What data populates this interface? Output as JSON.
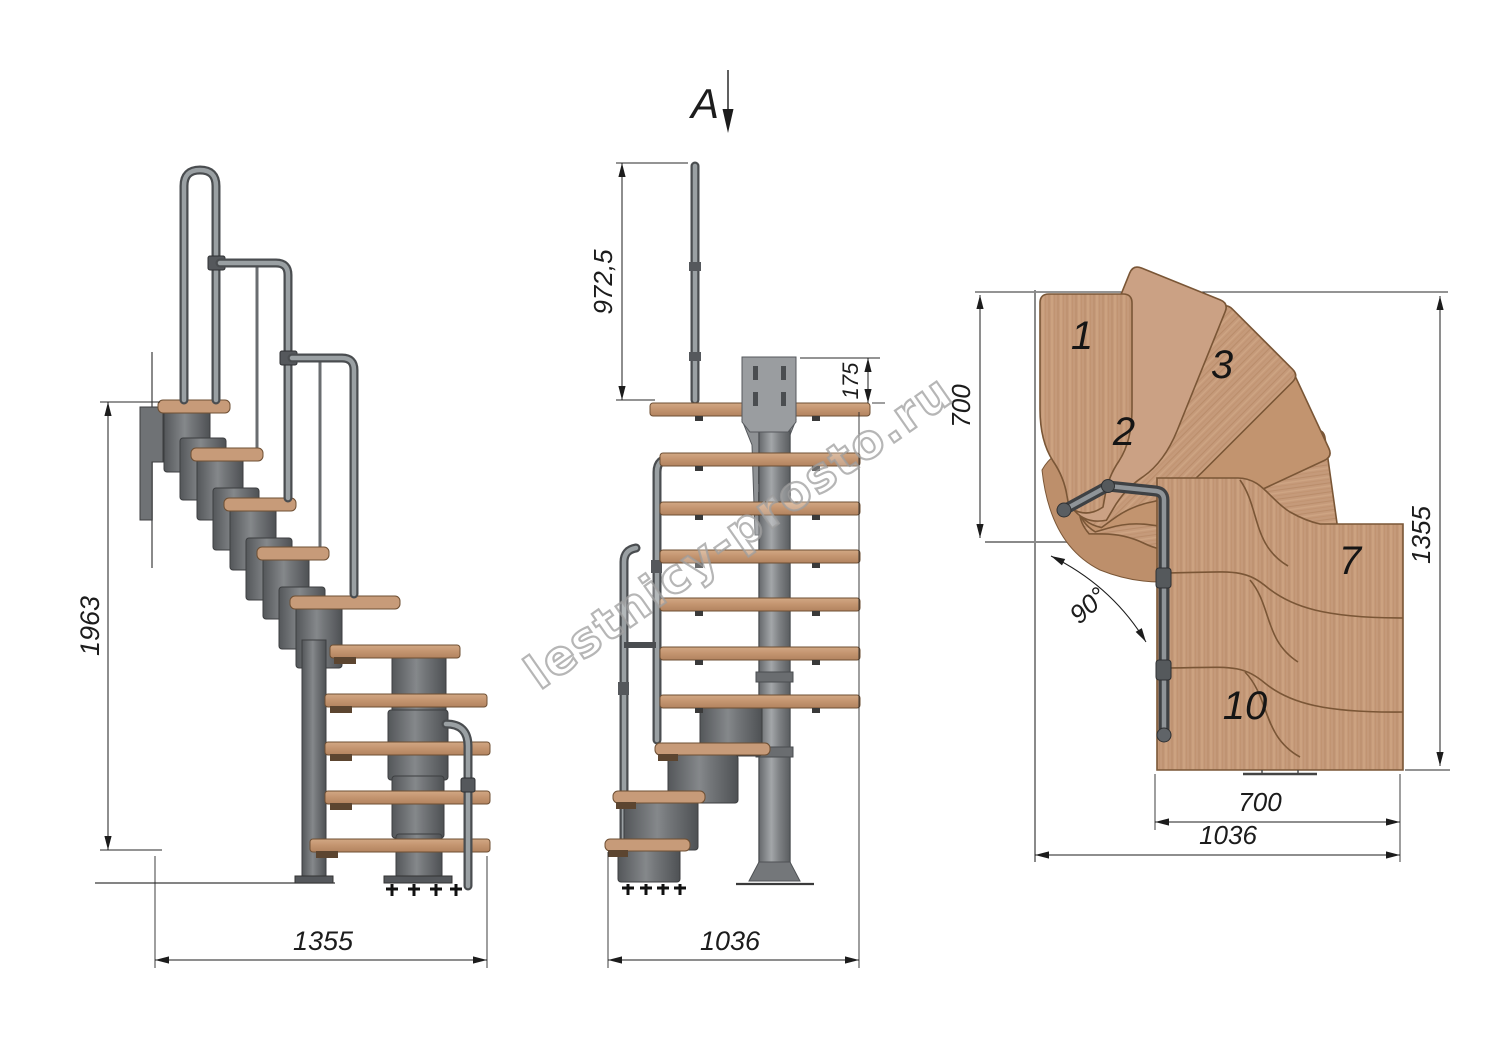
{
  "watermark": "lestnicy-prosto.ru",
  "section_arrow": {
    "label": "A"
  },
  "side_view": {
    "height_dim": "1963",
    "width_dim": "1355"
  },
  "front_view": {
    "rail_height_dim": "972,5",
    "plate_height_dim": "175",
    "width_dim": "1036"
  },
  "plan_view": {
    "entry_depth_dim": "700",
    "turn_angle": "90°",
    "length_dim": "1355",
    "lower_flight_width_dim": "700",
    "total_width_dim": "1036",
    "steps": [
      {
        "label": "1"
      },
      {
        "label": "2"
      },
      {
        "label": "3"
      },
      {
        "label": "7"
      },
      {
        "label": "10"
      }
    ]
  },
  "colors": {
    "wood": "#c79b79",
    "wood_edge": "#6e4f33",
    "metal": "#85888b",
    "metal_dark": "#55585c",
    "dimension_line": "#1c1c1c",
    "watermark_gray": "#9e9e9e"
  }
}
